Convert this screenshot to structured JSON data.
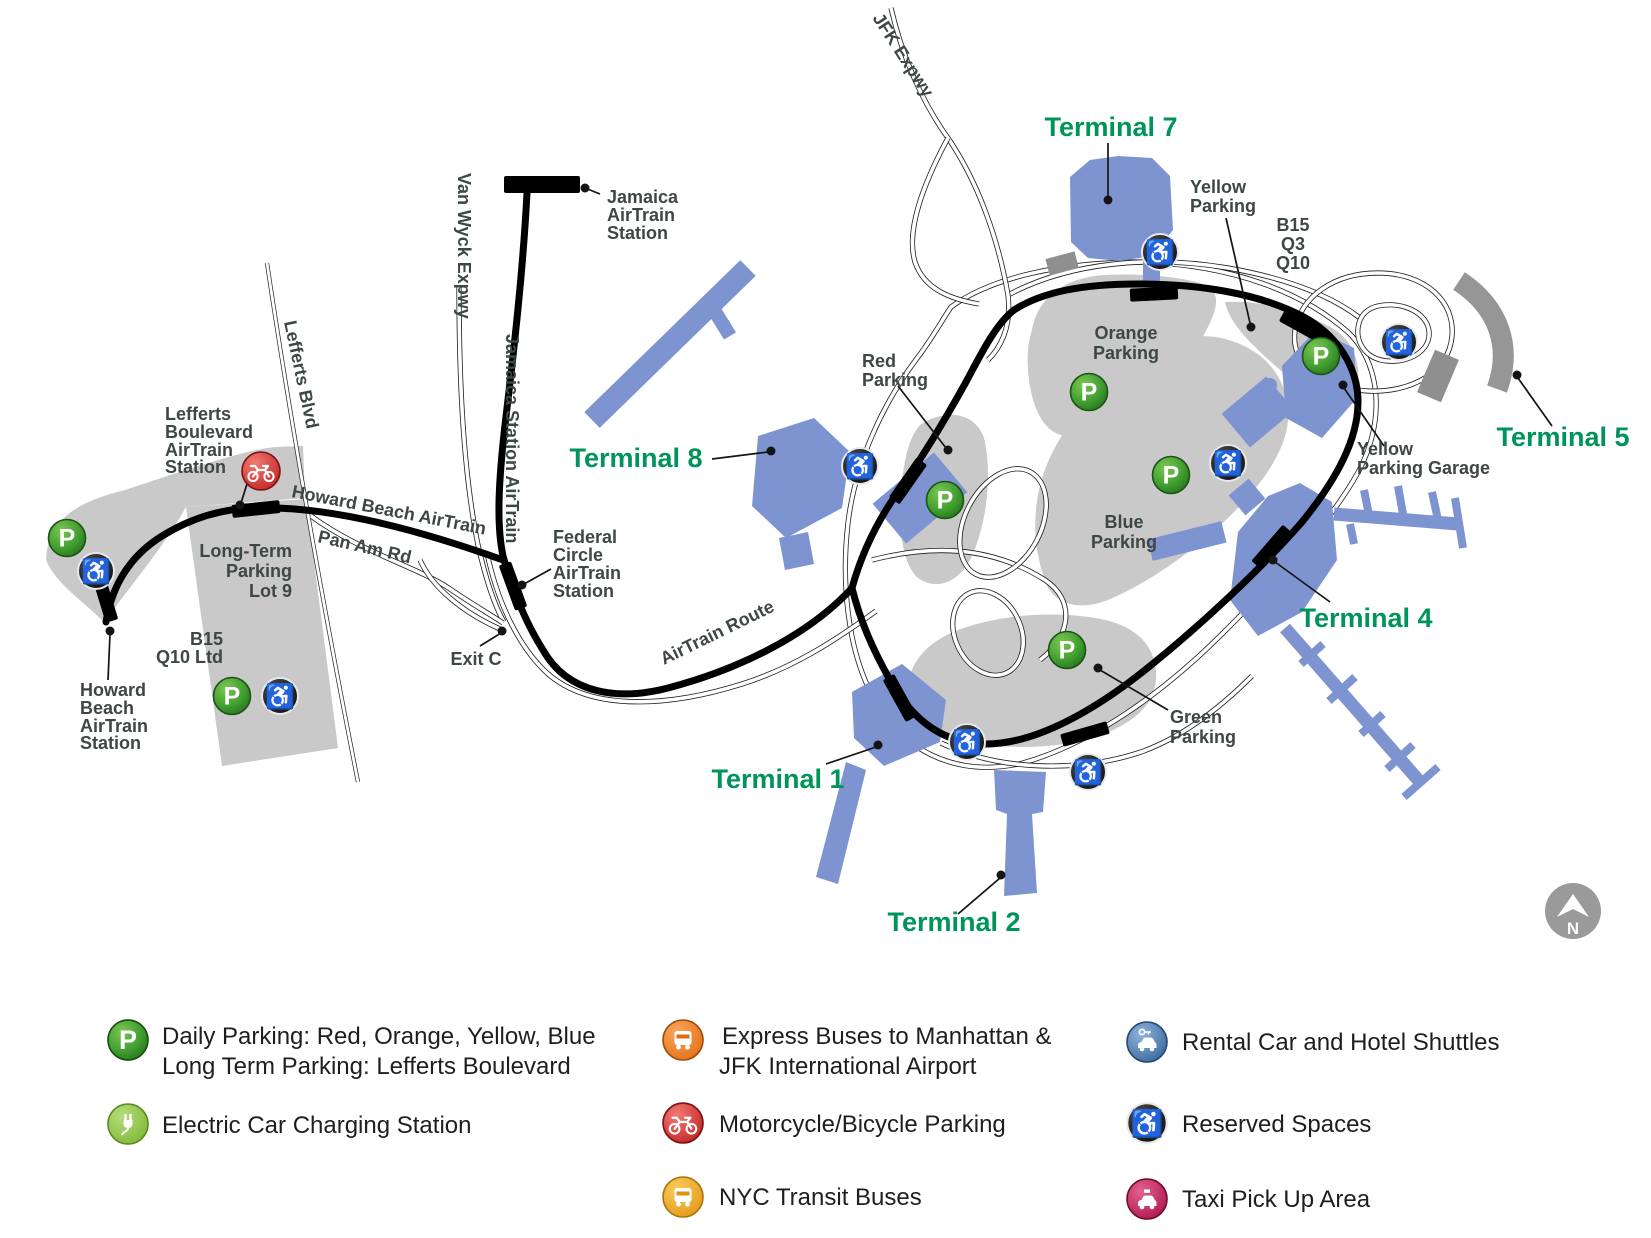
{
  "map": {
    "north_label": "N",
    "terminals": {
      "t1": "Terminal 1",
      "t2": "Terminal 2",
      "t4": "Terminal 4",
      "t5": "Terminal 5",
      "t7": "Terminal 7",
      "t8": "Terminal 8"
    },
    "roads": {
      "jfk_expwy": "JFK Expwy",
      "van_wyck": "Van Wyck Expwy",
      "lefferts_blvd": "Lefferts Blvd",
      "pan_am_rd": "Pan Am Rd",
      "exit_c": "Exit C",
      "howard_beach_line": "Howard Beach AirTrain",
      "jamaica_line": "Jamaica Station AirTrain",
      "airtrain_route": "AirTrain Route"
    },
    "stations": {
      "jamaica": [
        "Jamaica",
        "AirTrain",
        "Station"
      ],
      "lefferts": [
        "Lefferts",
        "Boulevard",
        "AirTrain",
        "Station"
      ],
      "howard_beach": [
        "Howard",
        "Beach",
        "AirTrain",
        "Station"
      ],
      "federal_circle": [
        "Federal",
        "Circle",
        "AirTrain",
        "Station"
      ]
    },
    "parking": {
      "red": [
        "Red",
        "Parking"
      ],
      "orange": [
        "Orange",
        "Parking"
      ],
      "yellow": [
        "Yellow",
        "Parking"
      ],
      "blue": [
        "Blue",
        "Parking"
      ],
      "green": [
        "Green",
        "Parking"
      ],
      "yellow_garage": [
        "Yellow",
        "Parking Garage"
      ],
      "long_term": [
        "Long-Term",
        "Parking",
        "Lot 9"
      ]
    },
    "bus_routes": {
      "b15_q10": [
        "B15",
        "Q10 Ltd"
      ],
      "b15_q3_q10": [
        "B15",
        "Q3",
        "Q10"
      ]
    }
  },
  "icons": {
    "parking_letter": "P",
    "wheelchair_glyph": "♿"
  },
  "colors": {
    "terminal_blue": "#7D94D1",
    "parking_gray": "#C9C9C9",
    "terminal_label_green": "#00935A",
    "label_gray": "#3E4742",
    "p_green": "#3F9D2F",
    "ev_green": "#8CC63F",
    "express_orange": "#EF7B21",
    "moto_red": "#D22B27",
    "nyc_bus_yellow": "#F2A71F",
    "rental_blue": "#4B7DB8",
    "reserved_black": "#161616",
    "taxi_pink": "#C7175C"
  },
  "legend": {
    "daily_parking_1": "Daily Parking: Red, Orange, Yellow, Blue",
    "daily_parking_2": "Long Term Parking: Lefferts Boulevard",
    "ev": "Electric Car Charging Station",
    "express_1": "Express Buses to Manhattan &",
    "express_2": "JFK International Airport",
    "moto": "Motorcycle/Bicycle Parking",
    "nyc_bus": "NYC Transit Buses",
    "rental": "Rental Car and Hotel Shuttles",
    "reserved": "Reserved Spaces",
    "taxi": "Taxi Pick Up Area"
  }
}
